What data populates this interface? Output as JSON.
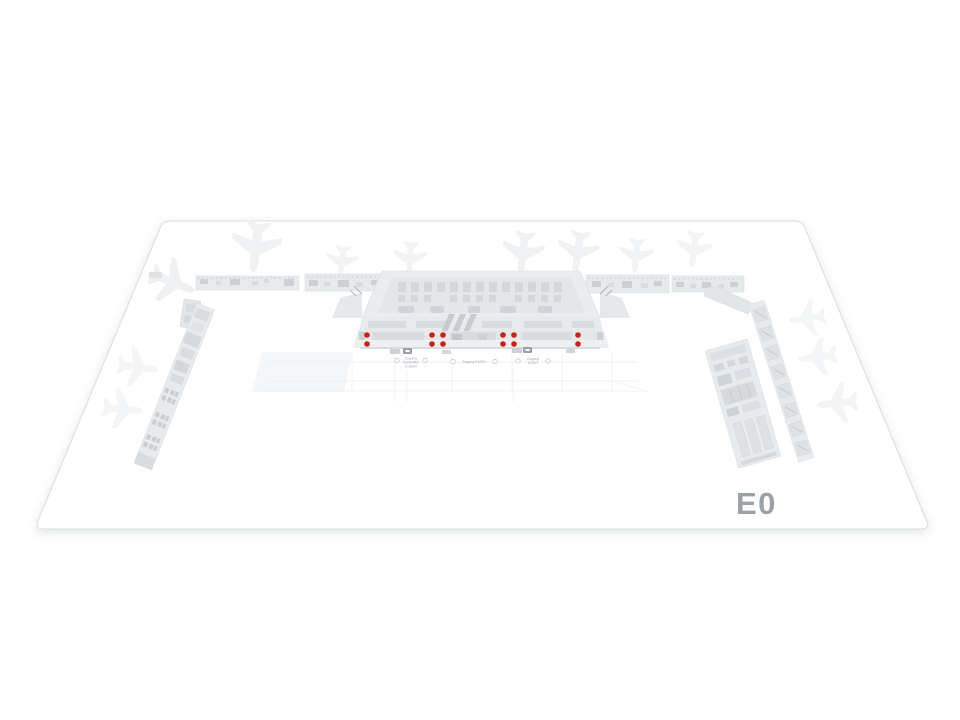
{
  "map": {
    "level_label": "E0",
    "colors": {
      "marker": "#cb2110",
      "ground_fill": "#ffffff",
      "ground_stroke": "#d9dde0",
      "building_light": "#e8ebed",
      "level_label_color": "#9aa1a7"
    },
    "marker_radius": 2.8,
    "markers": [
      [
        367,
        335
      ],
      [
        367,
        344
      ],
      [
        432,
        335
      ],
      [
        443,
        335
      ],
      [
        432,
        344
      ],
      [
        443,
        344
      ],
      [
        503,
        335
      ],
      [
        514,
        335
      ],
      [
        503,
        344
      ],
      [
        514,
        344
      ],
      [
        578,
        335
      ],
      [
        578,
        344
      ]
    ],
    "planes": [
      {
        "x": 256,
        "y": 246,
        "rot": 187,
        "scale": 1.25,
        "color": "#eff1f3"
      },
      {
        "x": 342,
        "y": 261,
        "rot": 186,
        "scale": 0.78,
        "color": "#f1f3f5"
      },
      {
        "x": 410,
        "y": 258,
        "rot": 184,
        "scale": 0.85,
        "color": "#f1f3f5"
      },
      {
        "x": 523,
        "y": 252,
        "rot": 187,
        "scale": 1.05,
        "color": "#eff1f3"
      },
      {
        "x": 578,
        "y": 251,
        "rot": 188,
        "scale": 1.02,
        "color": "#eff1f3"
      },
      {
        "x": 636,
        "y": 255,
        "rot": 185,
        "scale": 0.85,
        "color": "#f1f3f5"
      },
      {
        "x": 694,
        "y": 249,
        "rot": 187,
        "scale": 0.9,
        "color": "#f2f4f5"
      },
      {
        "x": 172,
        "y": 282,
        "rot": 112,
        "scale": 1.15,
        "color": "#eef0f2"
      },
      {
        "x": 137,
        "y": 367,
        "rot": 97,
        "scale": 1.0,
        "color": "#f3f5f6"
      },
      {
        "x": 122,
        "y": 409,
        "rot": 95,
        "scale": 1.0,
        "color": "#f3f5f6"
      },
      {
        "x": 808,
        "y": 318,
        "rot": 262,
        "scale": 0.9,
        "color": "#f3f5f6"
      },
      {
        "x": 818,
        "y": 357,
        "rot": 263,
        "scale": 0.95,
        "color": "#f3f5f6"
      },
      {
        "x": 838,
        "y": 403,
        "rot": 264,
        "scale": 1.0,
        "color": "#f2f4f5"
      }
    ],
    "labels": [
      {
        "lines": [
          "Zugang",
          "Bahn/RB/",
          "S-Bahn"
        ]
      },
      {
        "lines": [
          "Zugang E0/E/1"
        ]
      },
      {
        "lines": [
          "Zugang",
          "E0/E/1"
        ]
      }
    ]
  }
}
